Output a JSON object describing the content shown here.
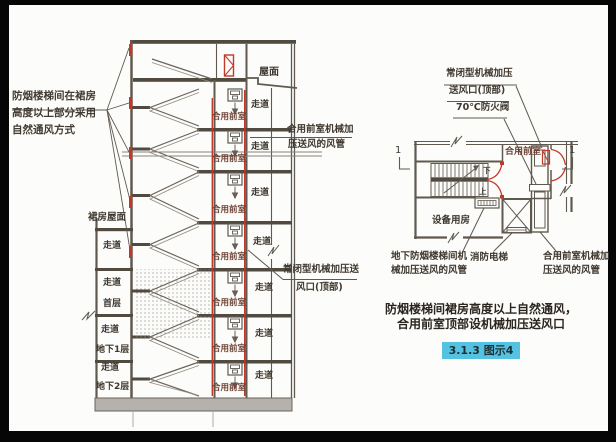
{
  "section_view": {
    "callout_natural_vent": [
      "防烟楼梯间在裙房",
      "高度以上部分采用",
      "自然通风方式"
    ],
    "roof": "屋面",
    "podium_roof": "裙房屋面",
    "corridor": "走道",
    "shared_lobby": "合用前室",
    "first_floor": "首层",
    "basement_1": "地下1层",
    "basement_2": "地下2层",
    "lobby_duct_label": [
      "合用前室机械加",
      "压送风的风管"
    ],
    "top_outlet_label": [
      "常闭型机械加压送",
      "风口(顶部)"
    ]
  },
  "plan_view": {
    "annotation": [
      "常闭型机械加压",
      "送风口(顶部)",
      "70℃防火阀"
    ],
    "shared_lobby": "合用前室",
    "equipment_room": "设备用房",
    "stair_down": "下",
    "stair_up": "上",
    "section_marker": "1",
    "basement_stair_duct_label": [
      "地下防烟楼梯间机",
      "械加压送风的风管"
    ],
    "fire_elevator_label": "消防电梯",
    "lobby_duct_label": [
      "合用前室机械加",
      "压送风的风管"
    ]
  },
  "caption": {
    "line1": "防烟楼梯间裙房高度以上自然通风，",
    "line2": "合用前室顶部设机械加压送风口",
    "figure_badge": "3.1.3 图示4"
  },
  "colors": {
    "line": "#5f594f",
    "red_accent": "#bf3a2b",
    "badge_bg": "#54c2e0",
    "ground_fill": "#b5b2ae",
    "page_bg": "#fcfcfa",
    "frame": "#060606"
  }
}
